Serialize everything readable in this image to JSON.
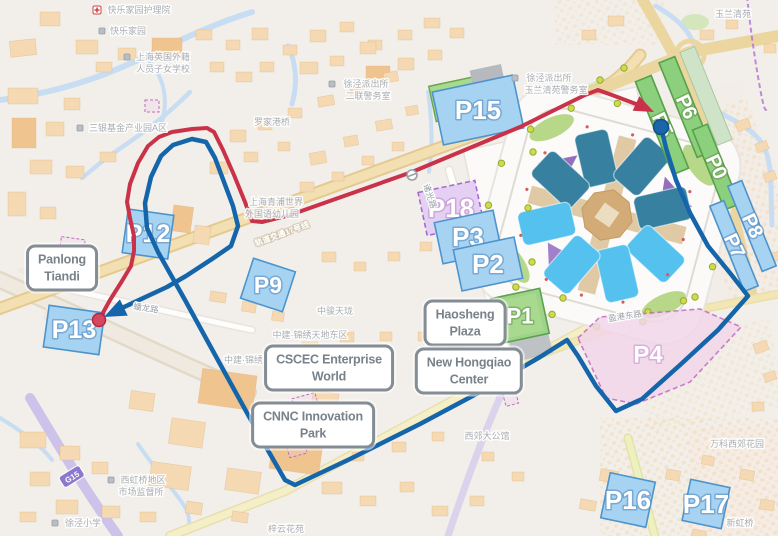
{
  "title": "Exhibition center shuttle route map",
  "colors": {
    "route_red": "#c93248",
    "route_blue": "#1565ab",
    "parking_blue_fill": "#a6d3f2",
    "parking_blue_stroke": "#4e94cc",
    "parking_green_fill": "#9ed489",
    "parking_green_stroke": "#5ba14e",
    "zone_pink_fill": "#f2d7ea",
    "zone_pink_stroke": "#c06ac2",
    "zone_purple_fill": "#e3d0f2",
    "zone_purple_stroke": "#a86ad0",
    "water": "#c9ddf2",
    "road_tan": "#ecd6a0",
    "building": "#f5d9b2",
    "hall_teal": "#38809f",
    "hall_blue": "#55c1ef",
    "hall_purple": "#8a63b8"
  },
  "parking_lots": [
    {
      "label": "P12",
      "type": "blue",
      "x": 148,
      "y": 234,
      "w": 46,
      "h": 44,
      "rot": 8,
      "fs": 25,
      "trot": 0
    },
    {
      "label": "P13",
      "type": "blue",
      "x": 74,
      "y": 330,
      "w": 56,
      "h": 42,
      "rot": 8,
      "fs": 25,
      "trot": 0
    },
    {
      "label": "P9",
      "type": "blue",
      "x": 268,
      "y": 285,
      "w": 44,
      "h": 42,
      "rot": 18,
      "fs": 23,
      "trot": 0
    },
    {
      "label": "P15",
      "type": "blue",
      "x": 478,
      "y": 110,
      "w": 82,
      "h": 54,
      "rot": -12,
      "fs": 26,
      "trot": 0
    },
    {
      "label": "P18",
      "type": "purple",
      "x": 451,
      "y": 208,
      "w": 58,
      "h": 44,
      "rot": -12,
      "fs": 26,
      "trot": 0
    },
    {
      "label": "P3",
      "type": "blue",
      "x": 468,
      "y": 237,
      "w": 60,
      "h": 42,
      "rot": -12,
      "fs": 26,
      "trot": 0
    },
    {
      "label": "P2",
      "type": "blue",
      "x": 488,
      "y": 264,
      "w": 62,
      "h": 42,
      "rot": -12,
      "fs": 26,
      "trot": 0
    },
    {
      "label": "P1",
      "type": "green",
      "x": 520,
      "y": 316,
      "w": 50,
      "h": 46,
      "rot": -12,
      "fs": 22,
      "trot": 0
    },
    {
      "label": "P4",
      "type": "pink",
      "poly": [
        [
          578,
          338
        ],
        [
          600,
          317
        ],
        [
          700,
          309
        ],
        [
          741,
          327
        ],
        [
          690,
          382
        ],
        [
          636,
          404
        ],
        [
          606,
          398
        ]
      ],
      "x": 648,
      "y": 355,
      "fs": 24,
      "trot": 0
    },
    {
      "label": "P16",
      "type": "blue",
      "x": 628,
      "y": 500,
      "w": 46,
      "h": 46,
      "rot": 12,
      "fs": 26,
      "trot": 0
    },
    {
      "label": "P17",
      "type": "blue",
      "x": 706,
      "y": 504,
      "w": 40,
      "h": 42,
      "rot": 12,
      "fs": 26,
      "trot": 0
    },
    {
      "label": "P5",
      "type": "green-strip",
      "x": 662,
      "y": 125,
      "w": 17,
      "h": 100,
      "rot": -22,
      "fs": 20,
      "trot": 65
    },
    {
      "label": "P6",
      "type": "green-strip",
      "x": 686,
      "y": 107,
      "w": 17,
      "h": 102,
      "rot": -22,
      "fs": 20,
      "trot": 65
    },
    {
      "label": "P0",
      "type": "green-strip",
      "x": 716,
      "y": 167,
      "w": 16,
      "h": 86,
      "rot": -22,
      "fs": 20,
      "trot": 65
    },
    {
      "label": "P8",
      "type": "blue-strip",
      "x": 752,
      "y": 226,
      "w": 15,
      "h": 92,
      "rot": -22,
      "fs": 20,
      "trot": 65
    },
    {
      "label": "P7",
      "type": "blue-strip",
      "x": 734,
      "y": 246,
      "w": 15,
      "h": 92,
      "rot": -22,
      "fs": 20,
      "trot": 65
    }
  ],
  "callouts": [
    {
      "id": "panlong-tiandi",
      "lines": [
        "Panlong",
        "Tiandi"
      ],
      "x": 62,
      "y": 268
    },
    {
      "id": "cscec-enterprise-world",
      "lines": [
        "CSCEC Enterprise",
        "World"
      ],
      "x": 329,
      "y": 368
    },
    {
      "id": "cnnc-innovation-park",
      "lines": [
        "CNNC Innovation",
        "Park"
      ],
      "x": 313,
      "y": 425
    },
    {
      "id": "haosheng-plaza",
      "lines": [
        "Haosheng",
        "Plaza"
      ],
      "x": 465,
      "y": 323
    },
    {
      "id": "new-hongqiao-center",
      "lines": [
        "New Hongqiao",
        "Center"
      ],
      "x": 469,
      "y": 371
    }
  ],
  "poi_labels": [
    {
      "text": "快乐家园护理院",
      "x": 139,
      "y": 10,
      "icon": "red-cross",
      "idx": -42
    },
    {
      "text": "快乐家园",
      "x": 128,
      "y": 31,
      "icon": "dot",
      "idx": -26
    },
    {
      "text": "上海英国外籍",
      "x": 163,
      "y": 57,
      "icon": "dot",
      "idx": -36
    },
    {
      "text": "人员子女学校",
      "x": 163,
      "y": 69
    },
    {
      "text": "三银基金产业园A区",
      "x": 128,
      "y": 128,
      "icon": "dot",
      "idx": -48
    },
    {
      "text": "罗家港桥",
      "x": 272,
      "y": 122
    },
    {
      "text": "徐泾派出所",
      "x": 366,
      "y": 84,
      "icon": "badge",
      "idx": -34
    },
    {
      "text": "二联警务室",
      "x": 368,
      "y": 96
    },
    {
      "text": "徐泾派出所",
      "x": 549,
      "y": 78,
      "icon": "badge",
      "idx": -34
    },
    {
      "text": "玉兰清苑警务室",
      "x": 556,
      "y": 90
    },
    {
      "text": "玉兰清苑",
      "x": 733,
      "y": 14
    },
    {
      "text": "上海青浦世界",
      "x": 276,
      "y": 202
    },
    {
      "text": "外国语幼儿园",
      "x": 272,
      "y": 214
    },
    {
      "text": "中骏天珑",
      "x": 335,
      "y": 311
    },
    {
      "text": "中建·锦绣天地东区",
      "x": 310,
      "y": 335
    },
    {
      "text": "中建·锦绣里",
      "x": 248,
      "y": 360
    },
    {
      "text": "西郊大公馆",
      "x": 487,
      "y": 436
    },
    {
      "text": "万科西郊花园",
      "x": 737,
      "y": 444
    },
    {
      "text": "西虹桥地区",
      "x": 143,
      "y": 480,
      "icon": "dot",
      "idx": -32
    },
    {
      "text": "市场监督所",
      "x": 141,
      "y": 492
    },
    {
      "text": "徐泾小学",
      "x": 83,
      "y": 523,
      "icon": "dot",
      "idx": -28
    },
    {
      "text": "梓云花苑",
      "x": 286,
      "y": 529
    },
    {
      "text": "新虹桥",
      "x": 740,
      "y": 523
    }
  ],
  "road_labels": [
    {
      "text": "轨道交通17号线",
      "x": 282,
      "y": 234,
      "rot": -20,
      "style": "white"
    },
    {
      "text": "诸光路",
      "x": 430,
      "y": 196,
      "rot": 72,
      "style": "gray"
    },
    {
      "text": "蟠龙路",
      "x": 146,
      "y": 308,
      "rot": 9,
      "style": "gray"
    },
    {
      "text": "盈港东路",
      "x": 625,
      "y": 316,
      "rot": -9,
      "style": "gray"
    },
    {
      "text": "G15",
      "x": 72,
      "y": 477,
      "rot": -32,
      "style": "badge"
    }
  ],
  "routes": {
    "red": {
      "color": "#c93248",
      "points": [
        [
          99,
          320
        ],
        [
          110,
          300
        ],
        [
          122,
          281
        ],
        [
          131,
          266
        ],
        [
          134,
          251
        ],
        [
          134,
          236
        ],
        [
          130,
          218
        ],
        [
          127,
          202
        ],
        [
          130,
          184
        ],
        [
          138,
          163
        ],
        [
          148,
          146
        ],
        [
          159,
          137
        ],
        [
          172,
          132
        ],
        [
          192,
          129
        ],
        [
          207,
          128
        ],
        [
          214,
          132
        ],
        [
          223,
          150
        ],
        [
          234,
          175
        ],
        [
          245,
          202
        ],
        [
          252,
          221
        ],
        [
          262,
          222
        ],
        [
          290,
          215
        ],
        [
          412,
          172
        ],
        [
          520,
          127
        ],
        [
          585,
          95
        ],
        [
          598,
          90
        ],
        [
          612,
          95
        ],
        [
          636,
          104
        ]
      ],
      "dot": [
        99,
        320
      ],
      "arrow": [
        [
          654,
          112
        ],
        [
          632.6,
          110.7
        ],
        [
          639.4,
          96.3
        ]
      ]
    },
    "blue": {
      "color": "#1565ab",
      "points": [
        [
          661,
          127
        ],
        [
          666,
          148
        ],
        [
          676,
          180
        ],
        [
          690,
          213
        ],
        [
          708,
          246
        ],
        [
          730,
          273
        ],
        [
          748,
          296
        ],
        [
          718,
          330
        ],
        [
          680,
          365
        ],
        [
          642,
          399
        ],
        [
          616,
          411
        ],
        [
          596,
          386
        ],
        [
          578,
          356
        ],
        [
          567,
          340
        ],
        [
          540,
          357
        ],
        [
          480,
          392
        ],
        [
          420,
          424
        ],
        [
          350,
          459
        ],
        [
          295,
          485
        ],
        [
          285,
          480
        ],
        [
          262,
          440
        ],
        [
          225,
          373
        ],
        [
          185,
          300
        ],
        [
          158,
          252
        ],
        [
          147,
          228
        ],
        [
          145,
          203
        ],
        [
          151,
          177
        ],
        [
          161,
          156
        ],
        [
          173,
          145
        ],
        [
          192,
          139
        ],
        [
          206,
          142
        ],
        [
          215,
          158
        ],
        [
          224,
          182
        ],
        [
          233,
          206
        ],
        [
          238,
          226
        ],
        [
          231,
          246
        ],
        [
          212,
          259
        ],
        [
          186,
          276
        ],
        [
          167,
          287
        ],
        [
          122,
          308
        ]
      ],
      "dot": [
        661,
        127
      ],
      "arrow": [
        [
          104,
          317
        ],
        [
          119.9,
          299.4
        ],
        [
          127.7,
          315.6
        ]
      ]
    }
  }
}
